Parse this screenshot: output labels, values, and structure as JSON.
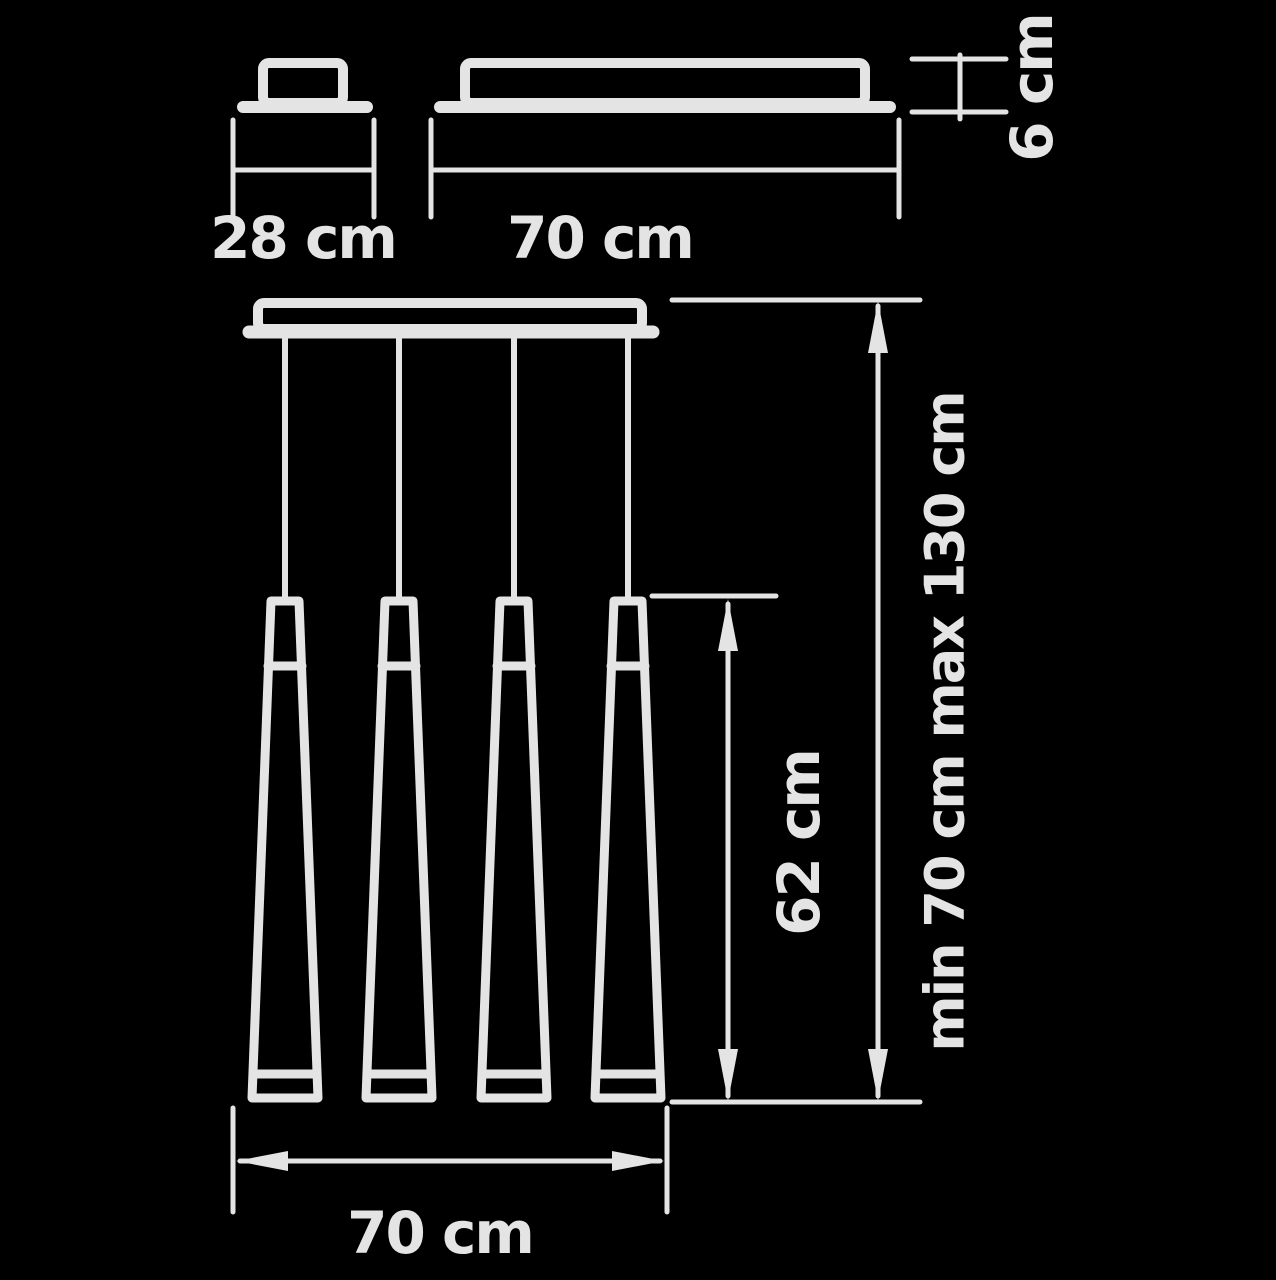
{
  "colors": {
    "background": "#000000",
    "line": "#e4e4e4",
    "text": "#e4e4e4"
  },
  "views": {
    "end_view": {
      "width_label": "28 cm"
    },
    "side_view": {
      "width_label": "70 cm",
      "canopy_height_label": "6 cm"
    },
    "front_view": {
      "pendant_count": 4,
      "shade_length_label": "62 cm",
      "suspension_range_label": "min 70 cm max 130 cm",
      "overall_width_label": "70 cm"
    }
  }
}
